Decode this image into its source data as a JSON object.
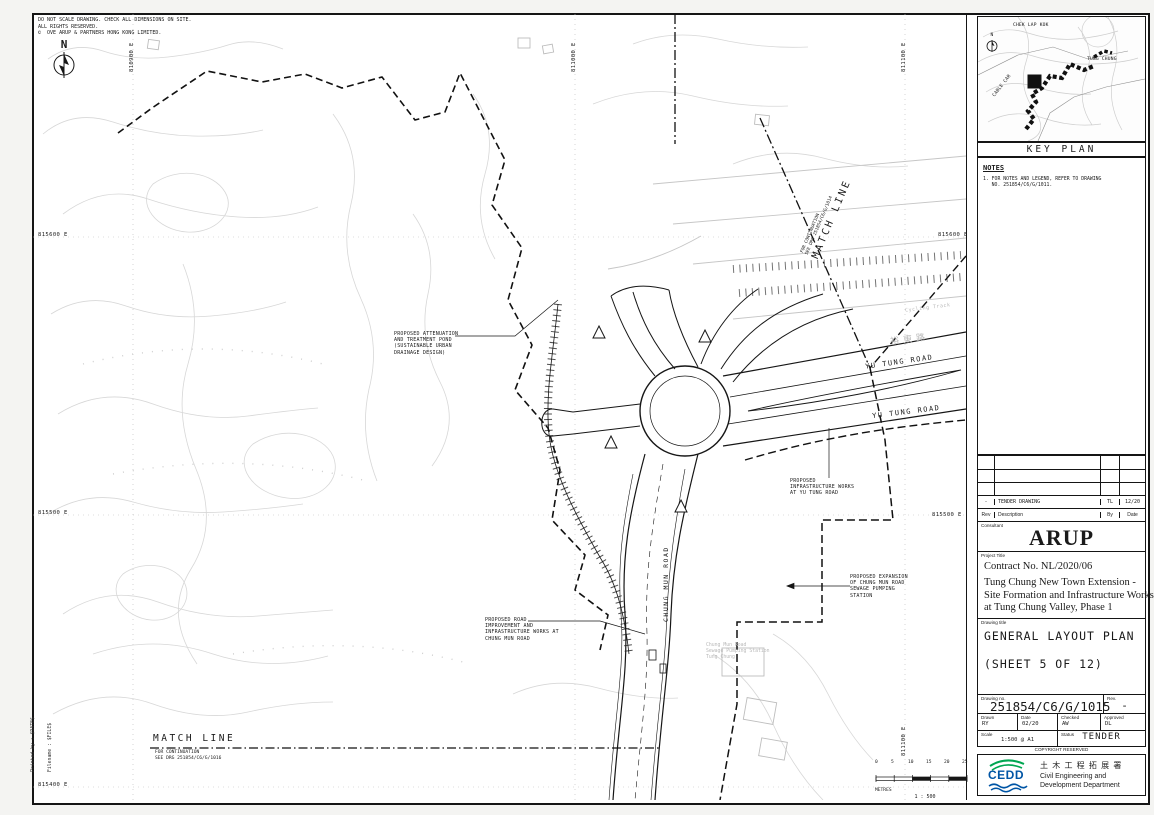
{
  "sheet": {
    "printed_by": "Printed by : $DATE$",
    "filename": "Filename : $FILE$",
    "disclaimer": "DO NOT SCALE DRAWING. CHECK ALL DIMENSIONS ON SITE.\nALL RIGHTS RESERVED.\n©  OVE ARUP & PARTNERS HONG KONG LIMITED."
  },
  "map": {
    "north_label": "N",
    "grid": {
      "left": [
        {
          "text": "815600 E"
        },
        {
          "text": "815500 E"
        },
        {
          "text": "815400 E"
        }
      ],
      "right": [
        {
          "text": "815600 E"
        },
        {
          "text": "815500 E"
        }
      ],
      "top": [
        {
          "text": "810900 E"
        },
        {
          "text": "811000 E"
        },
        {
          "text": "811100 E"
        }
      ],
      "bottom": [
        {
          "text": "811100 E"
        }
      ]
    },
    "match_line_top": {
      "title": "MATCH LINE",
      "note": "FOR CONTINUATION\nSEE DRG 251854/C6/G/1014"
    },
    "match_line_bottom": {
      "title": "MATCH LINE",
      "note": "FOR CONTINUATION\nSEE DRG 251854/C6/G/1016"
    },
    "annotations": {
      "attenuation": "PROPOSED ATTENUATION\nAND TREATMENT POND\n(SUSTAINABLE URBAN\nDRAINAGE DESIGN)",
      "yu_tung_works": "PROPOSED\nINFRASTRUCTURE WORKS\nAT YU TUNG ROAD",
      "pumping_station": "PROPOSED EXPANSION\nOF CHUNG MUN ROAD\nSEWAGE PUMPING\nSTATION",
      "chung_mun_works": "PROPOSED ROAD\nIMPROVEMENT AND\nINFRASTRUCTURE WORKS AT\nCHUNG MUN ROAD"
    },
    "roads": {
      "yu_tung_1": "YU TUNG ROAD",
      "yu_tung_2": "YU TUNG ROAD",
      "chung_mun": "CHUNG MUN ROAD",
      "yu_tung_cn": "裕東路",
      "cycling_track": "Cycling Track",
      "pumping_existing": "Chung Mun Road\nSewage Pumping Station\nTung Chung"
    },
    "scale_bar": {
      "ticks": [
        "0",
        "5",
        "10",
        "15",
        "20",
        "25"
      ],
      "unit": "METRES",
      "ratio": "1 : 500"
    }
  },
  "key_plan": {
    "title": "KEY PLAN",
    "label_chek_lap_kok": "CHEK LAP KOK",
    "label_tung_chung": "TUNG CHUNG",
    "label_cable_car": "CABLE CAR",
    "north_label": "N"
  },
  "notes": {
    "heading": "NOTES",
    "item_1": "1. FOR NOTES AND LEGEND, REFER TO DRAWING\n   NO. 251854/C6/G/1011."
  },
  "revisions": {
    "headers": {
      "rev": "Rev",
      "description": "Description",
      "by": "By",
      "date": "Date"
    },
    "entry": {
      "rev": "-",
      "description": "TENDER DRAWING",
      "by": "TL",
      "date": "12/20"
    }
  },
  "title_block": {
    "consultant_label": "Consultant",
    "consultant_name": "ARUP",
    "project_title_label": "Project Title",
    "contract": "Contract No. NL/2020/06",
    "project_title": "Tung Chung New Town Extension -\nSite Formation and Infrastructure Works\nat Tung Chung Valley, Phase 1",
    "drawing_title_label": "Drawing title",
    "drawing_title": "GENERAL LAYOUT PLAN",
    "drawing_sheet": "(SHEET 5 OF 12)",
    "drawing_no_label": "Drawing no.",
    "drawing_no": "251854/C6/G/1015",
    "rev_label": "Rev.",
    "rev": "-",
    "drawn_label": "Drawn",
    "drawn": "RY",
    "date_label": "Date",
    "date": "02/20",
    "checked_label": "Checked",
    "checked": "AW",
    "approved_label": "Approved",
    "approved": "DL",
    "scale_label": "Scale",
    "scale": "1:500 @ A1",
    "status_label": "Status",
    "status": "TENDER",
    "copyright": "COPYRIGHT  RESERVED"
  },
  "cedd": {
    "logo_text": "CEDD",
    "dept_cn": "土 木 工 程 拓 展 署",
    "dept_en": "Civil Engineering and\nDevelopment Department"
  }
}
